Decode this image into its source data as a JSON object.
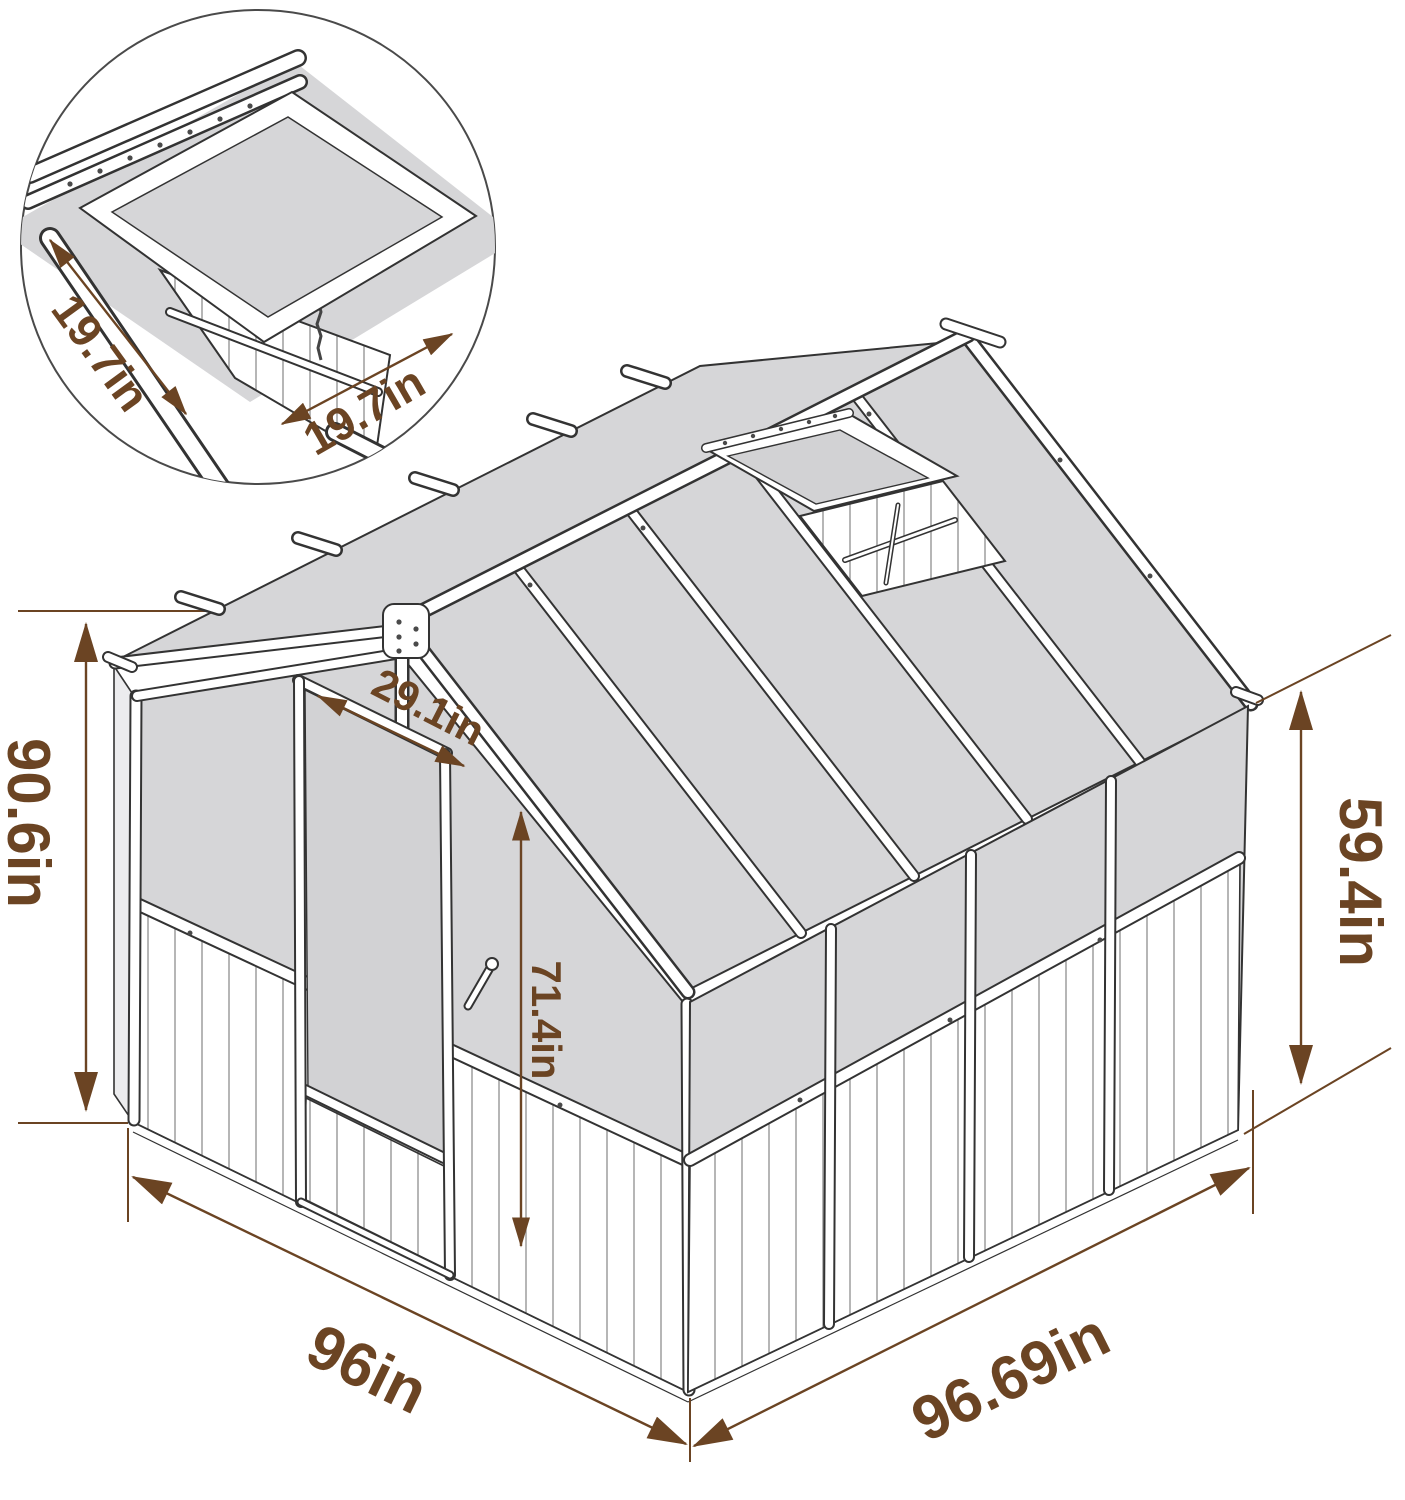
{
  "dimensions": {
    "overall_height": {
      "label": "90.6in"
    },
    "door_opening_width": {
      "label": "29.1in"
    },
    "door_height": {
      "label": "71.4in"
    },
    "front_width": {
      "label": "96in"
    },
    "depth": {
      "label": "96.69in"
    },
    "eave_height": {
      "label": "59.4in"
    }
  },
  "inset": {
    "vent_width": {
      "label": "19.7in"
    },
    "vent_depth": {
      "label": "19.7in"
    }
  },
  "colors": {
    "dimension_accent": "#6B4423",
    "panel_gray": "#D6D6D8",
    "frame_white": "#FFFFFF",
    "outline": "#333333"
  }
}
